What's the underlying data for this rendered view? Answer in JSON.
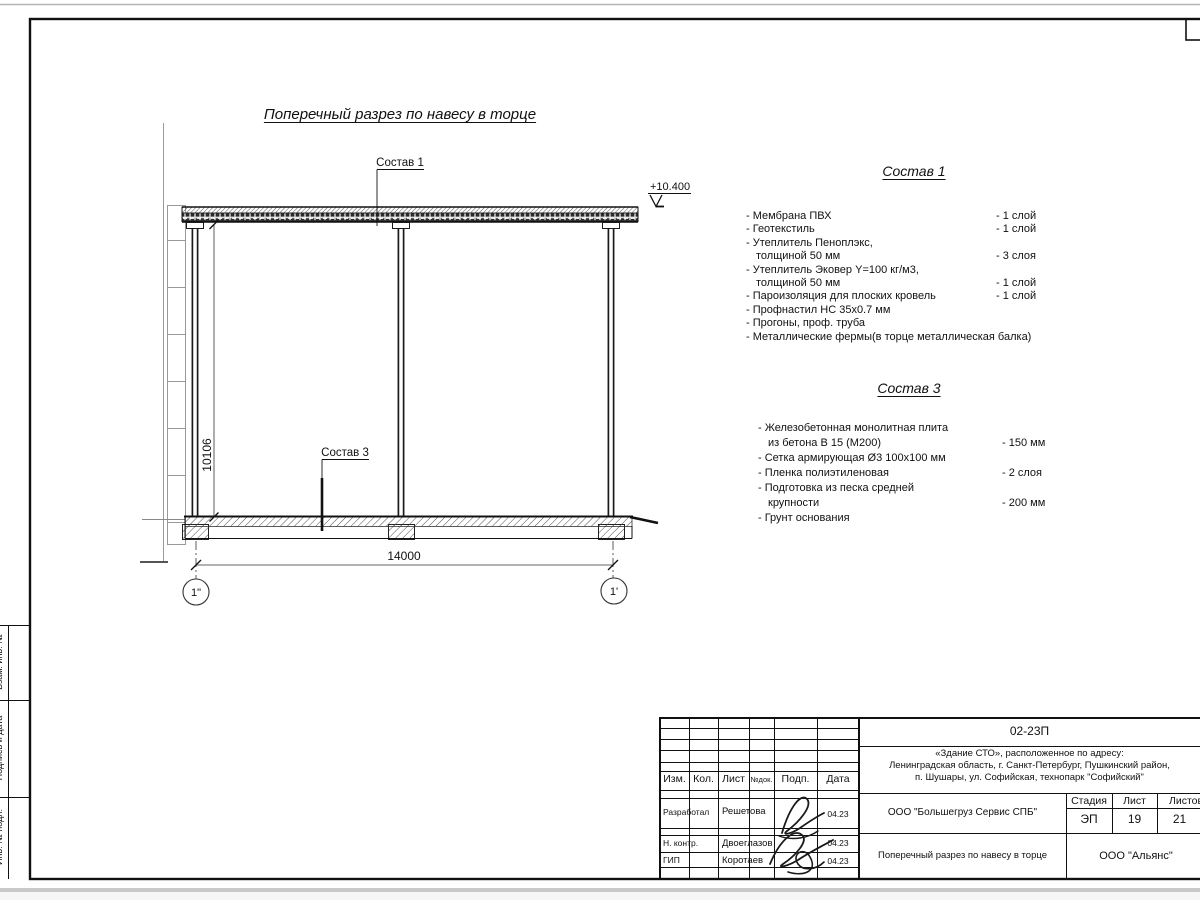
{
  "drawing": {
    "title": "Поперечный разрез по навесу в торце",
    "elevation": "+10.400",
    "leader1": "Состав 1",
    "leader3": "Состав 3",
    "dim_width": "14000",
    "dim_height": "10106",
    "axis_left": "1\"",
    "axis_right": "1'"
  },
  "sostav1": {
    "heading": "Состав 1",
    "items": [
      {
        "t": "- Мембрана ПВХ",
        "q": "- 1 слой"
      },
      {
        "t": "- Геотекстиль",
        "q": "- 1 слой"
      },
      {
        "t": "- Утеплитель Пеноплэкс,",
        "q": ""
      },
      {
        "t": "толщиной 50 мм",
        "q": "- 3 слоя"
      },
      {
        "t": "- Утеплитель Эковер Y=100 кг/м3,",
        "q": ""
      },
      {
        "t": "толщиной 50 мм",
        "q": "- 1 слой"
      },
      {
        "t": "- Пароизоляция для плоских кровель",
        "q": "- 1 слой"
      },
      {
        "t": "- Профнастил НС 35x0.7 мм",
        "q": ""
      },
      {
        "t": "- Прогоны, проф. труба",
        "q": ""
      },
      {
        "t": "- Металлические фермы(в торце металлическая балка)",
        "q": ""
      }
    ]
  },
  "sostav3": {
    "heading": "Состав 3",
    "items": [
      {
        "t": "- Железобетонная  монолитная плита",
        "q": ""
      },
      {
        "t": "из бетона В 15 (М200)",
        "q": "- 150 мм"
      },
      {
        "t": "- Сетка армирующая Ø3 100x100 мм",
        "q": ""
      },
      {
        "t": "- Пленка полиэтиленовая",
        "q": "-  2 слоя"
      },
      {
        "t": "- Подготовка из песка средней",
        "q": ""
      },
      {
        "t": "крупности",
        "q": "- 200 мм"
      },
      {
        "t": "- Грунт основания",
        "q": ""
      }
    ]
  },
  "titleblock": {
    "doc_number": "02-23П",
    "addr1": "«Здание СТО», расположенное по адресу:",
    "addr2": "Ленинградская область, г. Санкт-Петербург, Пушкинский район,",
    "addr3": "п. Шушары, ул. Софийская, технопарк \"Софийский\"",
    "headers": {
      "izm": "Изм.",
      "kol": "Кол.",
      "list": "Лист",
      "ndok": "№док.",
      "podp": "Подп.",
      "data": "Дата"
    },
    "rows": [
      {
        "role": "Разработал",
        "name": "Решетова",
        "date": "04.23"
      },
      {
        "role": "Н. контр.",
        "name": "Двоеглазов",
        "date": "04.23"
      },
      {
        "role": "ГИП",
        "name": "Коротаев",
        "date": "04.23"
      }
    ],
    "company": "ООО \"Большегруз Сервис СПБ\"",
    "stage_label": "Стадия",
    "sheet_label": "Лист",
    "sheets_label": "Листов",
    "stage": "ЭП",
    "sheet_no": "19",
    "sheets_total": "21",
    "drawing_name": "Поперечный разрез по навесу в торце",
    "org": "ООО \"Альянс\""
  },
  "side": {
    "vzam": "Взам. инв. №",
    "podpis": "Подпись и дата",
    "inv": "Инв. № подл."
  }
}
